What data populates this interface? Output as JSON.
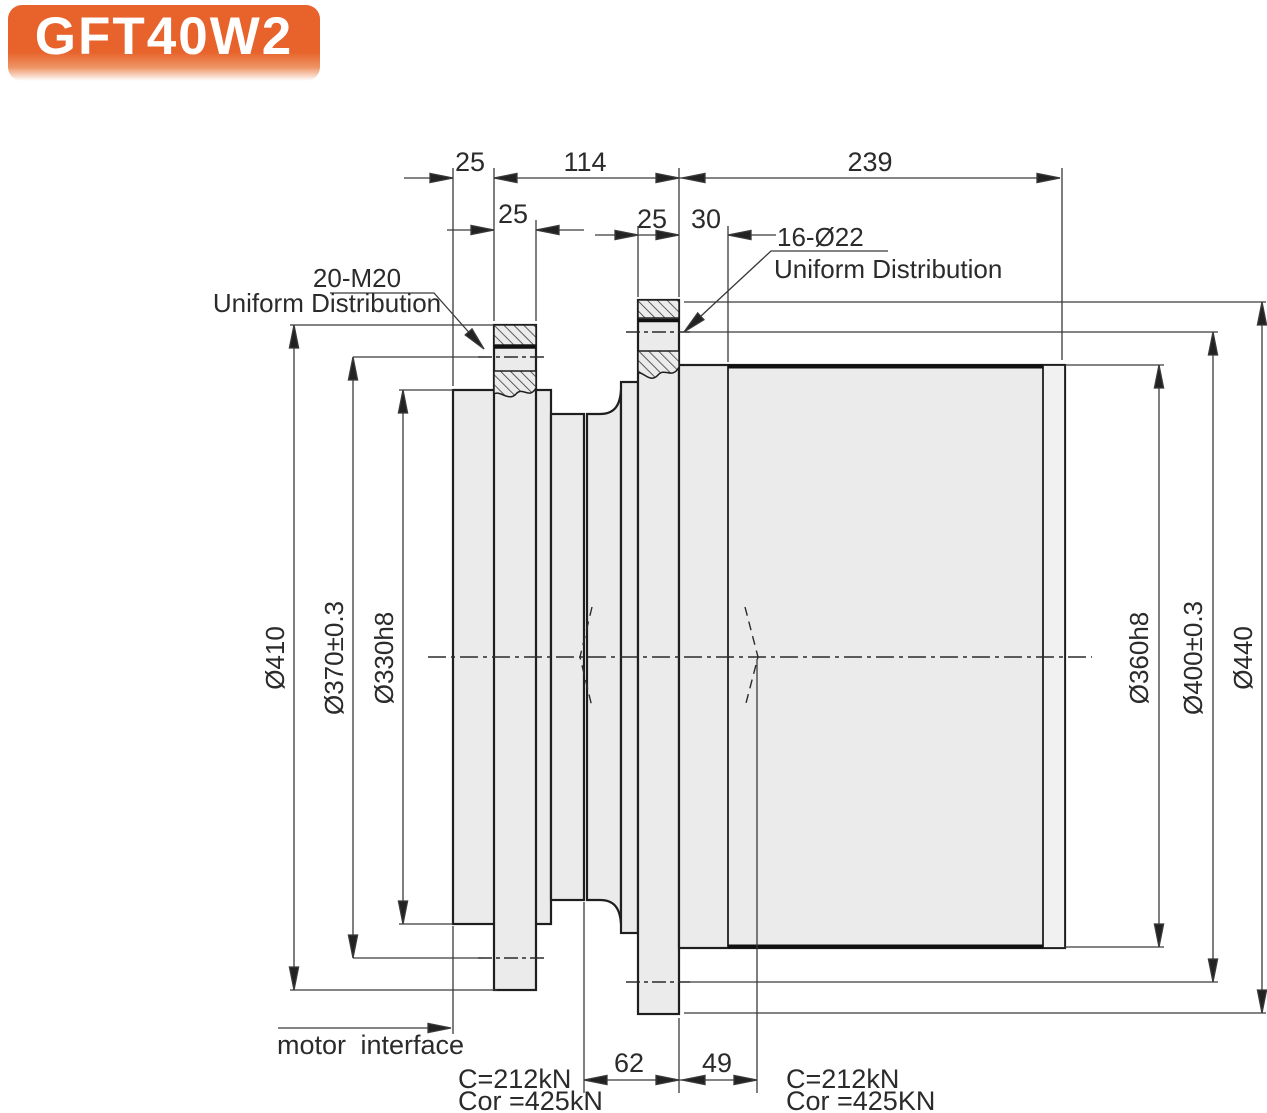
{
  "badge": {
    "model": "GFT40W2"
  },
  "colors": {
    "accent_orange": "#e7632b",
    "line": "#1f1f1f",
    "fill_gray": "#ebebeb"
  },
  "callouts": {
    "left": {
      "title": "20-M20",
      "subtitle": "Uniform Distribution"
    },
    "right": {
      "title": "16-Ø22",
      "subtitle": "Uniform Distribution"
    }
  },
  "dims": {
    "top1_25": "25",
    "top1_114": "114",
    "top1_239": "239",
    "top2_25": "25",
    "top3_25": "25",
    "top3_30": "30",
    "bottom_62": "62",
    "bottom_49": "49",
    "dia_410": "Ø410",
    "dia_370": "Ø370±0.3",
    "dia_330": "Ø330h8",
    "dia_360": "Ø360h8",
    "dia_400": "Ø400±0.3",
    "dia_440": "Ø440"
  },
  "labels": {
    "motor_interface": "motor interface",
    "left_c": "C=212kN",
    "left_cor": "Cor =425kN",
    "right_c": "C=212kN",
    "right_cor": "Cor =425KN"
  }
}
